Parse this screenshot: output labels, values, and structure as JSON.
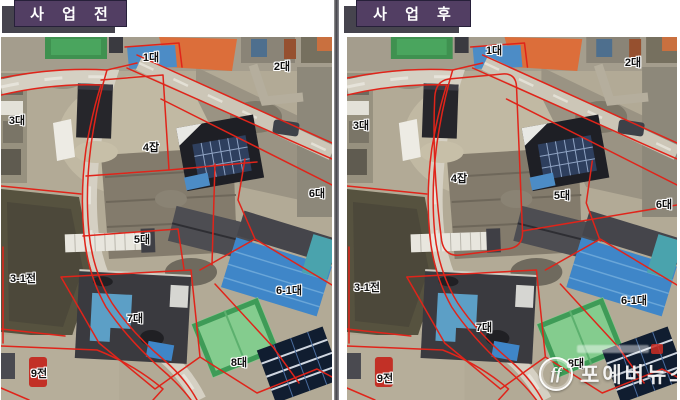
{
  "colors": {
    "header_bg": "#523e63",
    "header_shadow": "#46444e",
    "boundary_red": "#e0241a",
    "label_color": "#101010",
    "label_halo": "#ffffff"
  },
  "panels": [
    {
      "id": "before",
      "title": "사 업 전",
      "labels": [
        {
          "text": "1대",
          "x": 150,
          "y": 20
        },
        {
          "text": "2대",
          "x": 281,
          "y": 29
        },
        {
          "text": "3대",
          "x": 16,
          "y": 83
        },
        {
          "text": "4잡",
          "x": 150,
          "y": 110
        },
        {
          "text": "5대",
          "x": 141,
          "y": 202
        },
        {
          "text": "6대",
          "x": 316,
          "y": 156
        },
        {
          "text": "6-1대",
          "x": 288,
          "y": 253
        },
        {
          "text": "7대",
          "x": 134,
          "y": 281
        },
        {
          "text": "8대",
          "x": 238,
          "y": 325
        },
        {
          "text": "9전",
          "x": 38,
          "y": 336
        },
        {
          "text": "3-1전",
          "x": 22,
          "y": 241
        }
      ]
    },
    {
      "id": "after",
      "title": "사 업 후",
      "labels": [
        {
          "text": "1대",
          "x": 147,
          "y": 13
        },
        {
          "text": "2대",
          "x": 286,
          "y": 25
        },
        {
          "text": "3대",
          "x": 14,
          "y": 88
        },
        {
          "text": "4잡",
          "x": 112,
          "y": 141
        },
        {
          "text": "5대",
          "x": 215,
          "y": 158
        },
        {
          "text": "6대",
          "x": 317,
          "y": 167
        },
        {
          "text": "6-1대",
          "x": 287,
          "y": 263
        },
        {
          "text": "7대",
          "x": 137,
          "y": 290
        },
        {
          "text": "8대",
          "x": 229,
          "y": 326
        },
        {
          "text": "9전",
          "x": 38,
          "y": 341
        },
        {
          "text": "3-1전",
          "x": 20,
          "y": 250
        }
      ],
      "watermark": {
        "name": "포에버뉴스",
        "logo": "ff"
      }
    }
  ]
}
